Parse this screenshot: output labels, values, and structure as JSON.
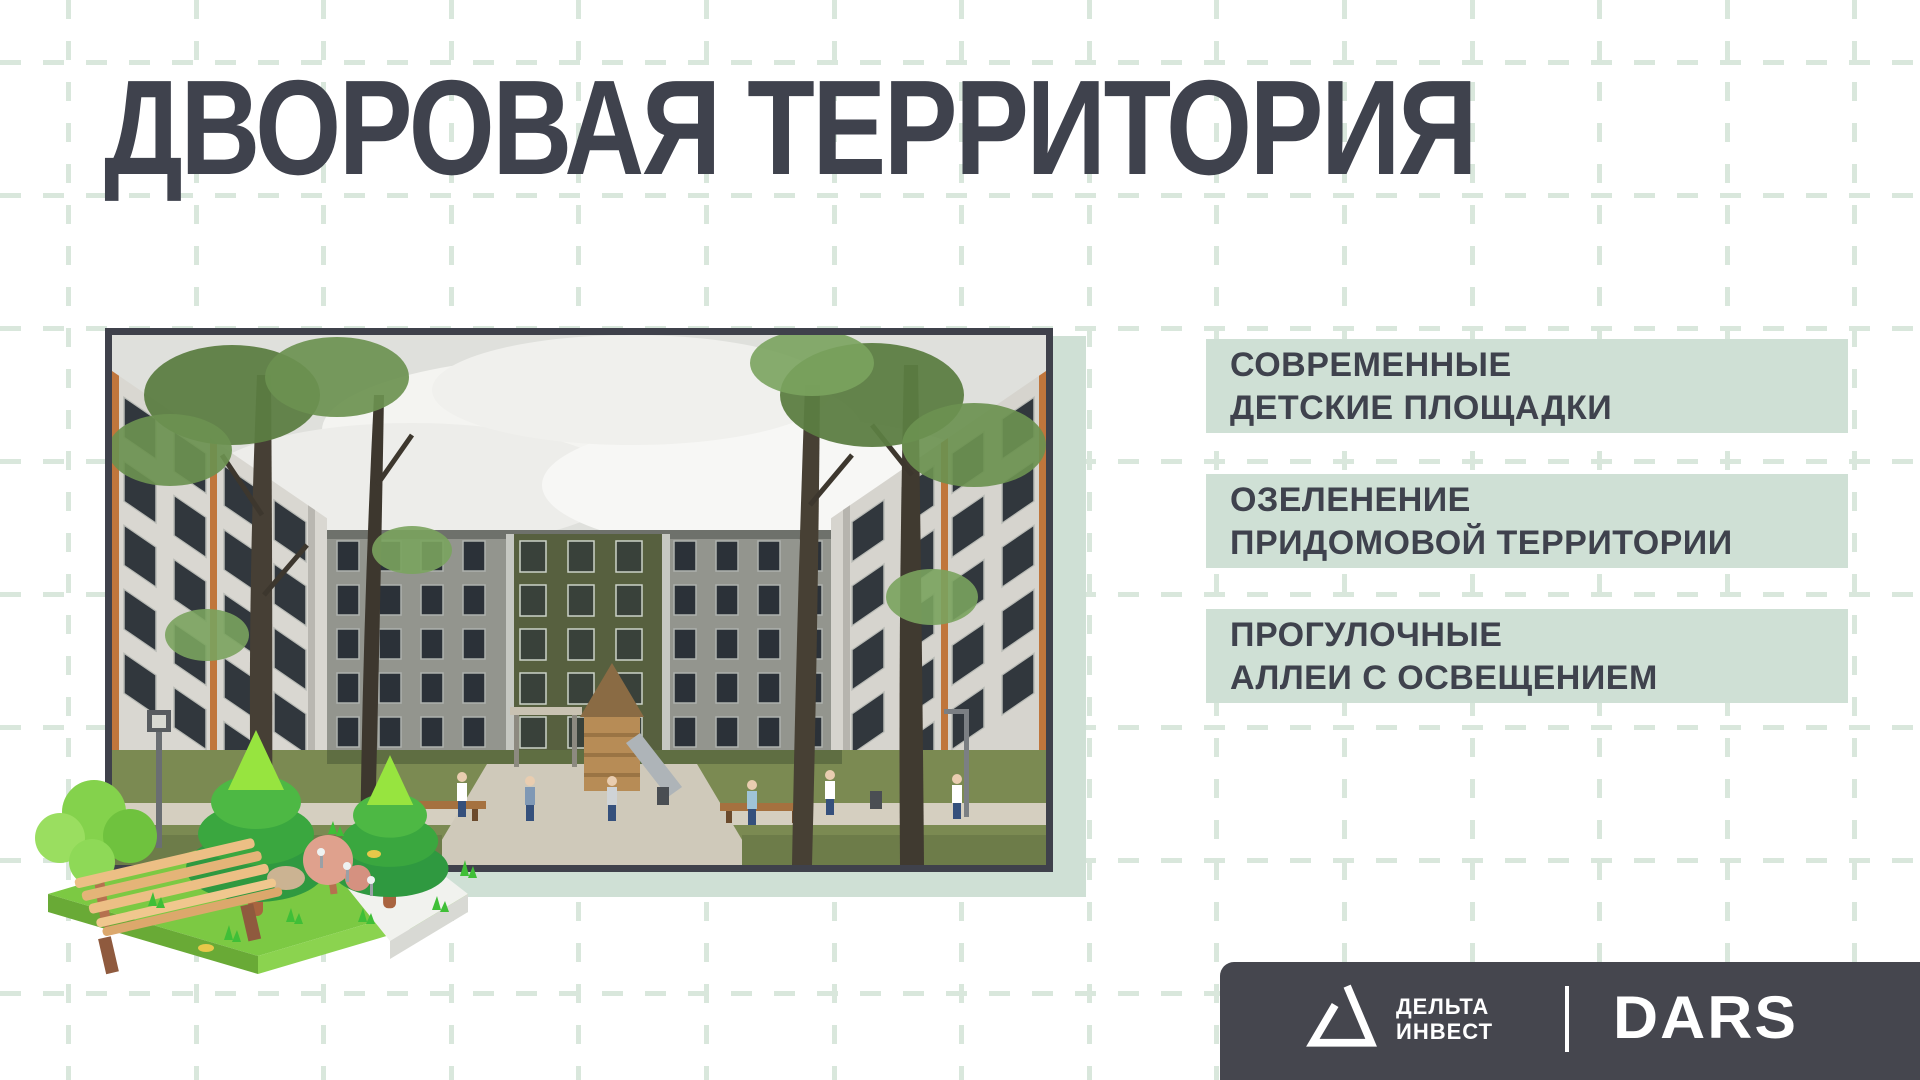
{
  "title": {
    "text": "ДВОРОВАЯ ТЕРРИТОРИЯ",
    "color": "#3f424d"
  },
  "features": {
    "bg_color": "#cfe0d5",
    "text_color": "#3f424d",
    "items": [
      {
        "line1": "СОВРЕМЕННЫЕ",
        "line2": "ДЕТСКИЕ ПЛОЩАДКИ"
      },
      {
        "line1": "ОЗЕЛЕНЕНИЕ",
        "line2": "ПРИДОМОВОЙ ТЕРРИТОРИИ"
      },
      {
        "line1": "ПРОГУЛОЧНЫЕ",
        "line2": "АЛЛЕИ С ОСВЕЩЕНИЕМ"
      }
    ]
  },
  "photo": {
    "frame_color": "#3f414b",
    "shadow_color": "#cfe0d5",
    "illustration_icon": "park-bench-trees-3d-icon"
  },
  "background": {
    "grid_color": "#d9e7dc",
    "page_color": "#ffffff"
  },
  "footer": {
    "bg_color": "#45464e",
    "brand": {
      "logo_icon": "delta-triangle-icon",
      "name_line1": "ДЕЛЬТА",
      "name_line2": "ИНВЕСТ"
    },
    "partner": "DARS",
    "divider_color": "#ffffff"
  }
}
